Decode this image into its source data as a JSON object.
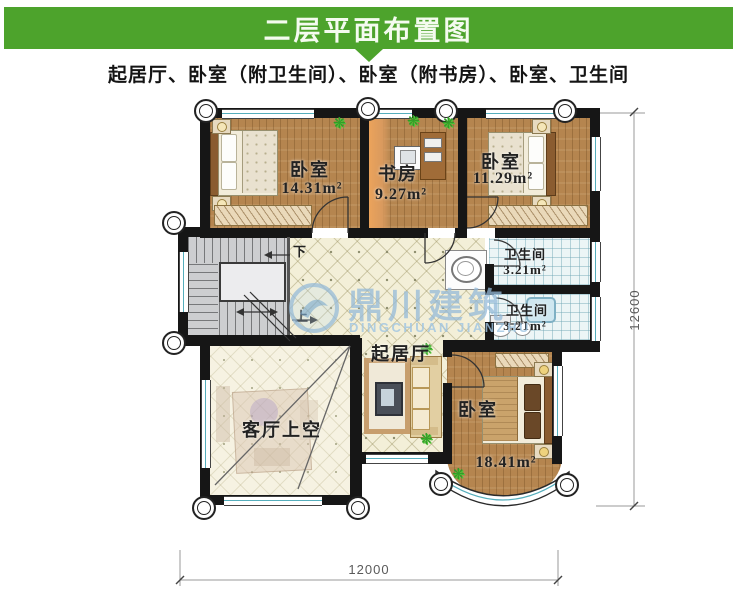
{
  "header": {
    "title": "二层平面布置图"
  },
  "subtitle": {
    "text": "起居厅、卧室（附卫生间）、卧室（附书房）、卧室、卫生间"
  },
  "rooms": {
    "bedroom_tl": {
      "label": "卧室",
      "area": "14.31m²"
    },
    "study": {
      "label": "书房",
      "area": "9.27m²"
    },
    "bedroom_tr": {
      "label": "卧室",
      "area": "11.29m²"
    },
    "bath_upper": {
      "label": "卫生间",
      "area": "3.21m²"
    },
    "bath_lower": {
      "label": "卫生间",
      "area": "3.21m²"
    },
    "living_hall": {
      "label": "起居厅"
    },
    "void": {
      "label": "客厅上空"
    },
    "bedroom_br": {
      "label": "卧室",
      "area": "18.41m²"
    }
  },
  "stairs": {
    "down": "下",
    "up": "上"
  },
  "dimensions": {
    "vertical": "12600",
    "horizontal": "12000"
  },
  "watermark": {
    "cn": "鼎川建筑",
    "en": "DINGCHUAN JIANZHU"
  },
  "colors": {
    "header_green": "#4da32c",
    "wall_black": "#161616",
    "wood_floor": "#b5854f",
    "tile_cream": "#f3efd8",
    "bath_blue": "#ecf5f6",
    "window_teal": "#55aebc",
    "watermark_blue": "#94bad8"
  }
}
